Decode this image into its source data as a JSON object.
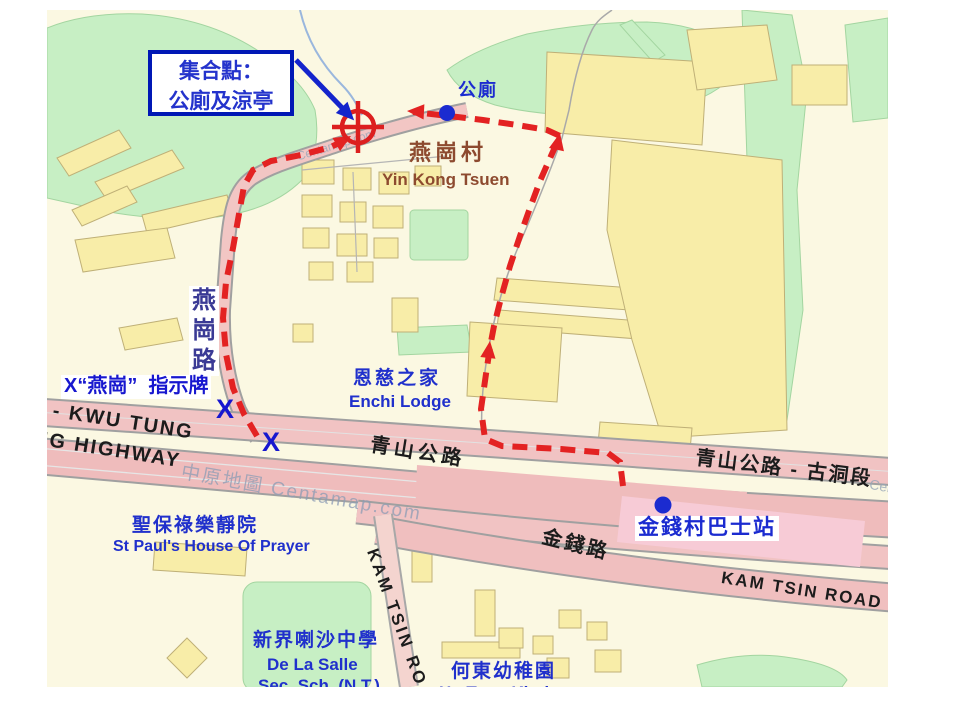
{
  "map": {
    "left": 47,
    "top": 10,
    "width": 841,
    "height": 677,
    "bg": "#fbf8e2"
  },
  "colors": {
    "annotation_red": "#e32222",
    "annotation_blue": "#1424cc",
    "label_blue": "#2030cc",
    "village_brown": "#8d4a2f",
    "road_pink": "#efbcbc",
    "road_pink_light": "#f2c6c4",
    "highlight_pink": "#f7cbd6",
    "green": "#c7efc4",
    "building_yellow": "#f8eda8",
    "watermark": "#8d9db5",
    "road_text": "#1c1c1c"
  },
  "callout": {
    "x": 101,
    "y": 40,
    "width": 146,
    "height": 66,
    "border_color": "#0018b5",
    "bg": "#ffffff",
    "text_color": "#2433cc",
    "font_size": 21,
    "line1": "集合點：",
    "line2": "公廁及涼亭"
  },
  "pointer_arrow": {
    "x1": 249,
    "y1": 50,
    "x2": 303,
    "y2": 106,
    "color": "#1424cc",
    "width": 5
  },
  "target_marker": {
    "name": "meeting-point-target",
    "x": 311,
    "y": 117,
    "r": 16,
    "cross": 26,
    "color": "#dc1f1f",
    "stroke": 4.5
  },
  "dots": [
    {
      "name": "public-toilet-dot",
      "x": 400,
      "y": 103,
      "r": 8,
      "color": "#1b2bd0"
    },
    {
      "name": "bus-stop-dot",
      "x": 616,
      "y": 495,
      "r": 8.5,
      "color": "#1b2bd0"
    }
  ],
  "routes": [
    {
      "name": "route-via-yin-kong-road",
      "color": "#e32222",
      "width": 6,
      "dash": "15 9",
      "points": [
        [
          210,
          426
        ],
        [
          197,
          404
        ],
        [
          186,
          378
        ],
        [
          179,
          344
        ],
        [
          176,
          308
        ],
        [
          179,
          272
        ],
        [
          186,
          238
        ],
        [
          192,
          204
        ],
        [
          197,
          176
        ],
        [
          206,
          160
        ],
        [
          224,
          151
        ],
        [
          254,
          145
        ],
        [
          284,
          137
        ],
        [
          300,
          129
        ]
      ],
      "arrows": [
        {
          "x": 304,
          "y": 126,
          "angle": -30
        }
      ]
    },
    {
      "name": "route-from-bus-stop",
      "color": "#e32222",
      "width": 6,
      "dash": "15 9",
      "points": [
        [
          576,
          476
        ],
        [
          573,
          452
        ],
        [
          561,
          443
        ],
        [
          514,
          439
        ],
        [
          455,
          436
        ],
        [
          438,
          429
        ],
        [
          434,
          399
        ],
        [
          439,
          364
        ],
        [
          443,
          337
        ],
        [
          447,
          316
        ],
        [
          454,
          288
        ],
        [
          463,
          256
        ],
        [
          473,
          226
        ],
        [
          483,
          198
        ],
        [
          493,
          171
        ],
        [
          504,
          146
        ],
        [
          513,
          126
        ],
        [
          500,
          120
        ],
        [
          470,
          115
        ],
        [
          436,
          110
        ],
        [
          402,
          106
        ],
        [
          366,
          102
        ]
      ],
      "arrows": [
        {
          "x": 443,
          "y": 331,
          "angle": -83
        },
        {
          "x": 513,
          "y": 123,
          "angle": -78
        },
        {
          "x": 360,
          "y": 101,
          "angle": 183
        }
      ]
    }
  ],
  "labels": [
    {
      "name": "label-public-toilet",
      "text": "公廁",
      "x": 411,
      "y": 70,
      "size": 18,
      "color": "#1b2bd0",
      "bold": true,
      "spacing": 2
    },
    {
      "name": "label-yin-kong-tsuen-cn",
      "text": "燕崗村",
      "x": 362,
      "y": 130,
      "size": 22,
      "color": "#8d4a2f",
      "bold": true,
      "spacing": 4
    },
    {
      "name": "label-yin-kong-tsuen-en",
      "text": "Yin Kong Tsuen",
      "x": 335,
      "y": 160,
      "size": 17,
      "color": "#8d4a2f",
      "bold": true
    },
    {
      "name": "label-enchi-lodge-cn",
      "text": "恩慈之家",
      "x": 306,
      "y": 358,
      "size": 19,
      "color": "#2030cc",
      "bold": true,
      "spacing": 3
    },
    {
      "name": "label-enchi-lodge-en",
      "text": "Enchi Lodge",
      "x": 302,
      "y": 382,
      "size": 17,
      "color": "#2030cc",
      "bold": true
    },
    {
      "name": "label-st-paul-cn",
      "text": "聖保祿樂靜院",
      "x": 85,
      "y": 505,
      "size": 19,
      "color": "#2030cc",
      "bold": true,
      "spacing": 2
    },
    {
      "name": "label-st-paul-en",
      "text": "St Paul's House Of Prayer",
      "x": 66,
      "y": 528,
      "size": 16,
      "color": "#2030cc",
      "bold": true
    },
    {
      "name": "label-de-la-salle-cn",
      "text": "新界喇沙中學",
      "x": 206,
      "y": 620,
      "size": 19,
      "color": "#2030cc",
      "bold": true,
      "spacing": 2
    },
    {
      "name": "label-de-la-salle-en1",
      "text": "De La Salle",
      "x": 220,
      "y": 645,
      "size": 17,
      "color": "#2030cc",
      "bold": true
    },
    {
      "name": "label-de-la-salle-en2",
      "text": "Sec. Sch. (N.T.)",
      "x": 211,
      "y": 666,
      "size": 17,
      "color": "#2030cc",
      "bold": true
    },
    {
      "name": "label-ho-tung-cn",
      "text": "何東幼稚園",
      "x": 404,
      "y": 651,
      "size": 19,
      "color": "#2030cc",
      "bold": true,
      "spacing": 2
    },
    {
      "name": "label-ho-tung-en",
      "text": "Ho Tung Kindergarten",
      "x": 392,
      "y": 673,
      "size": 17,
      "color": "#2030cc",
      "bold": true
    },
    {
      "name": "label-castle-peak-road",
      "text": "青山公路",
      "x": 325,
      "y": 424,
      "size": 20,
      "color": "#1c1c1c",
      "bold": true,
      "rot": 9,
      "spacing": 4
    },
    {
      "name": "label-castle-peak-road-kwu-tung",
      "text": "青山公路 - 古洞段",
      "x": 650,
      "y": 437,
      "size": 20,
      "color": "#1c1c1c",
      "bold": true,
      "rot": 7,
      "spacing": 2
    },
    {
      "name": "label-kwu-tung",
      "text": "D - KWU TUNG",
      "x": -16,
      "y": 386,
      "size": 20,
      "color": "#1c1c1c",
      "bold": true,
      "rot": 9,
      "spacing": 2
    },
    {
      "name": "label-highway",
      "text": "NG HIGHWAY",
      "x": -12,
      "y": 417,
      "size": 20,
      "color": "#1c1c1c",
      "bold": true,
      "rot": 9,
      "spacing": 2
    },
    {
      "name": "label-kam-tsin-road-cn",
      "text": "金錢路",
      "x": 498,
      "y": 516,
      "size": 20,
      "color": "#1c1c1c",
      "bold": true,
      "rot": 14,
      "spacing": 3
    },
    {
      "name": "label-kam-tsin-road-en",
      "text": "KAM TSIN ROAD",
      "x": 676,
      "y": 558,
      "size": 17,
      "color": "#1c1c1c",
      "bold": true,
      "rot": 9,
      "spacing": 2
    },
    {
      "name": "label-kam-tsin-road-vertical",
      "text": "KAM TSIN ROAD",
      "x": 334,
      "y": 536,
      "size": 17,
      "color": "#1c1c1c",
      "bold": true,
      "rot": 70,
      "spacing": 3
    },
    {
      "name": "watermark-centamap-highway",
      "text": "中原地圖 Centamap.com",
      "x": 136,
      "y": 452,
      "size": 19,
      "color": "#8d9db5",
      "rot": 10,
      "opacity": 0.75,
      "spacing": 2
    },
    {
      "name": "watermark-centamap-road",
      "text": "Centamap.com",
      "x": 248,
      "y": 140,
      "size": 12,
      "color": "#97a6b8",
      "rot": -17,
      "opacity": 0.8
    },
    {
      "name": "watermark-centamap-right",
      "text": "Centamap",
      "x": 824,
      "y": 466,
      "size": 14,
      "color": "#97a6b8",
      "rot": 10,
      "opacity": 0.8
    },
    {
      "name": "label-yin-kong-road",
      "lines": [
        "燕",
        "崗",
        "路"
      ],
      "x": 142,
      "y": 276,
      "size": 24,
      "color": "#3a3a95",
      "bold": true,
      "bg": "#ffffff"
    },
    {
      "name": "label-sign-note",
      "text": "X“燕崗”  指示牌",
      "x": 14,
      "y": 365,
      "size": 20,
      "color": "#1717cf",
      "bold": true,
      "bg": "#ffffff"
    },
    {
      "name": "mark-x-upper",
      "text": "X",
      "x": 169,
      "y": 384,
      "size": 27,
      "color": "#1717cf",
      "bold": true
    },
    {
      "name": "mark-x-lower",
      "text": "X",
      "x": 215,
      "y": 417,
      "size": 27,
      "color": "#1717cf",
      "bold": true
    },
    {
      "name": "label-bus-stop",
      "text": "金錢村巴士站",
      "x": 588,
      "y": 506,
      "size": 21,
      "color": "#1b2bd0",
      "bold": true,
      "bg": "#ffffff",
      "spacing": 2
    }
  ]
}
